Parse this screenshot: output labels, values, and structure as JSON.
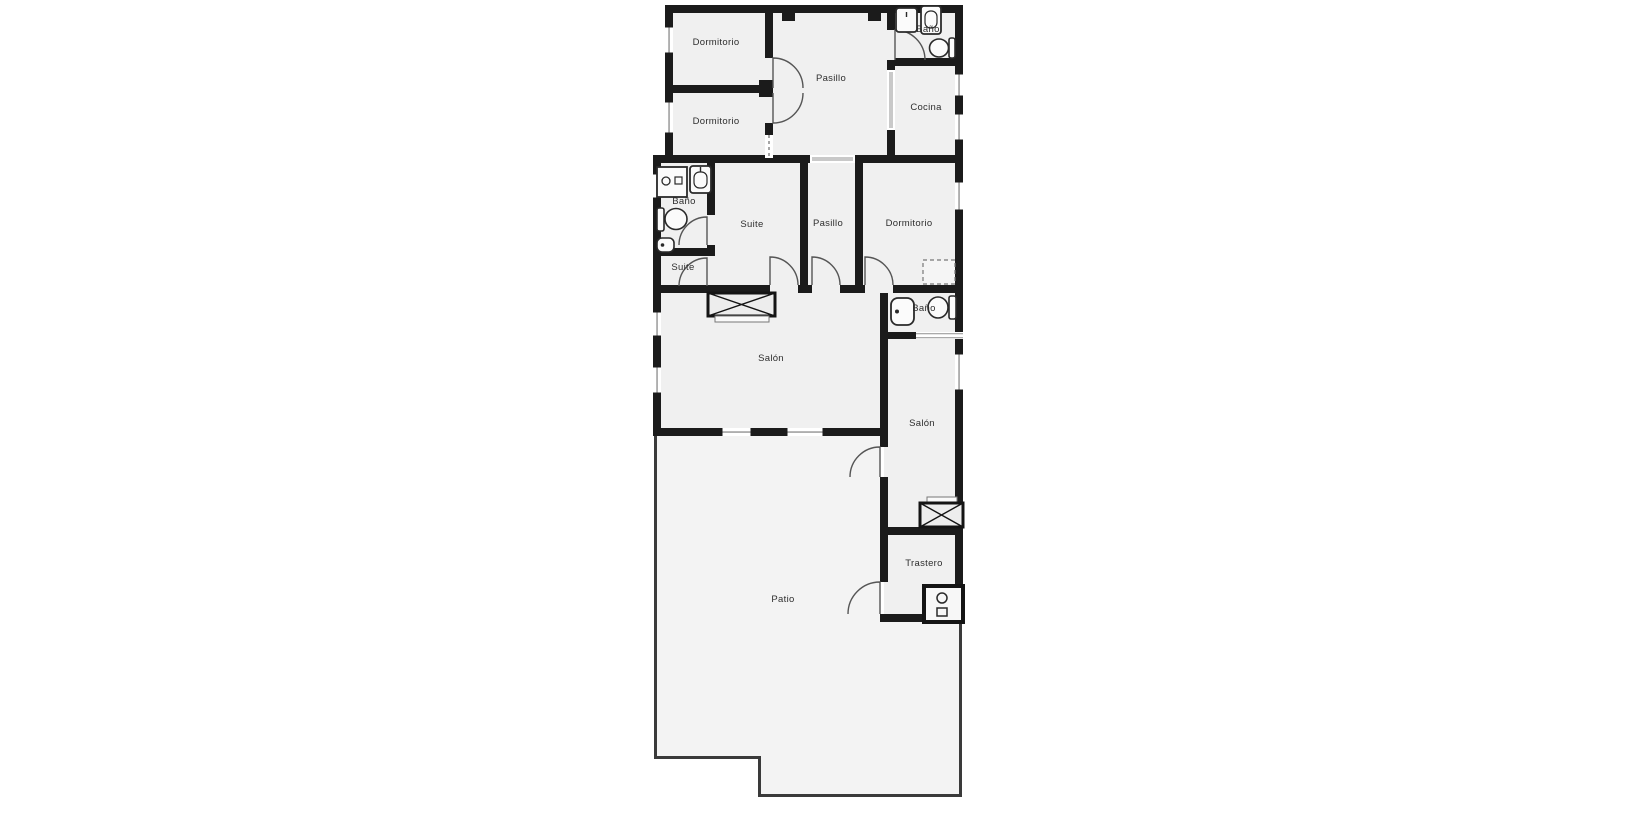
{
  "floorplan": {
    "kind": "residential-floor-plan",
    "language": "es",
    "colors": {
      "background": "#ffffff",
      "room_fill": "#f0f0f0",
      "patio_fill": "#f3f3f3",
      "wall": "#1b1b1b",
      "patio_wall": "#3a3a3a",
      "door": "#555555",
      "window": "#9a9a9a",
      "fixture": "#2a2a2a",
      "label": "#2e2e2e"
    },
    "rooms": [
      {
        "name": "dormitorio-1",
        "label": "Dormitorio"
      },
      {
        "name": "dormitorio-2",
        "label": "Dormitorio"
      },
      {
        "name": "pasillo-1",
        "label": "Pasillo"
      },
      {
        "name": "bano-1",
        "label": "Baño"
      },
      {
        "name": "cocina",
        "label": "Cocina"
      },
      {
        "name": "bano-2",
        "label": "Baño"
      },
      {
        "name": "suite-1",
        "label": "Suite"
      },
      {
        "name": "pasillo-2",
        "label": "Pasillo"
      },
      {
        "name": "dormitorio-3",
        "label": "Dormitorio"
      },
      {
        "name": "suite-2",
        "label": "Suite"
      },
      {
        "name": "salon-1",
        "label": "Salón"
      },
      {
        "name": "bano-3",
        "label": "Baño"
      },
      {
        "name": "salon-2",
        "label": "Salón"
      },
      {
        "name": "trastero",
        "label": "Trastero"
      },
      {
        "name": "patio",
        "label": "Patio"
      }
    ]
  }
}
